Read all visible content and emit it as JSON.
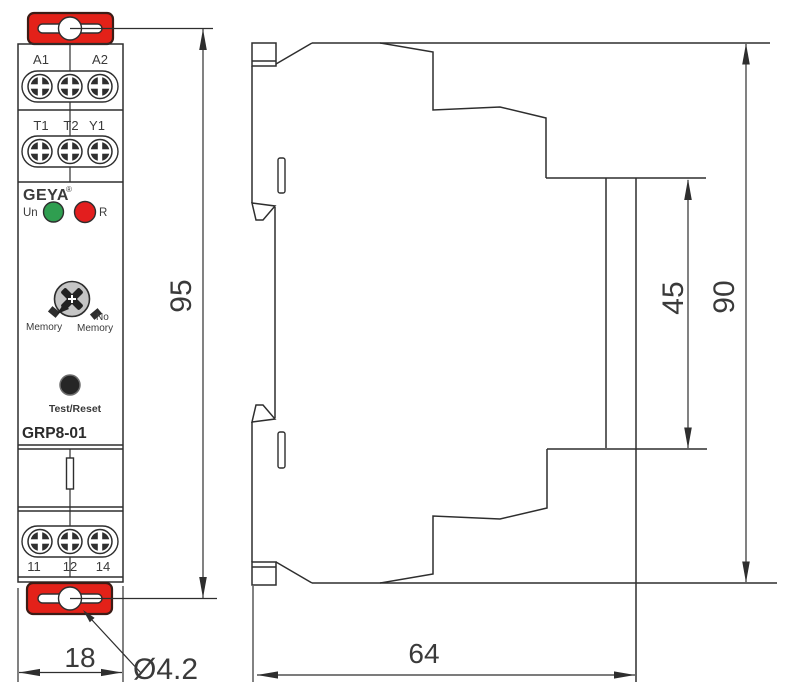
{
  "drawing_title": "GRP8-01 timer relay dimensional drawing",
  "front_view": {
    "brand": "GEYA",
    "reg_mark": "®",
    "model": "GRP8-01",
    "power_led_label": "Un",
    "relay_led_label": "R",
    "knob_labels": {
      "left": "Memory",
      "right_line1": "No",
      "right_line2": "Memory"
    },
    "button_label": "Test/Reset",
    "terminal_rows": {
      "row1": [
        "A1",
        "A2"
      ],
      "row2": [
        "T1",
        "T2",
        "Y1"
      ],
      "row3": [
        "11",
        "12",
        "14"
      ]
    }
  },
  "dimensions": {
    "overall_height": "95",
    "front_width": "18",
    "mounting_hole_diameter": "Ø4.2",
    "depth": "64",
    "rear_recess_height": "45",
    "rear_height": "90"
  },
  "colors": {
    "line": "#2e2e2e",
    "clip_red": "#e32119",
    "clip_outline": "#3c1c16",
    "led_green": "#2f9e50",
    "led_red": "#e31e1e",
    "knob_gray": "#c5c5c5",
    "button_black": "#262626"
  }
}
